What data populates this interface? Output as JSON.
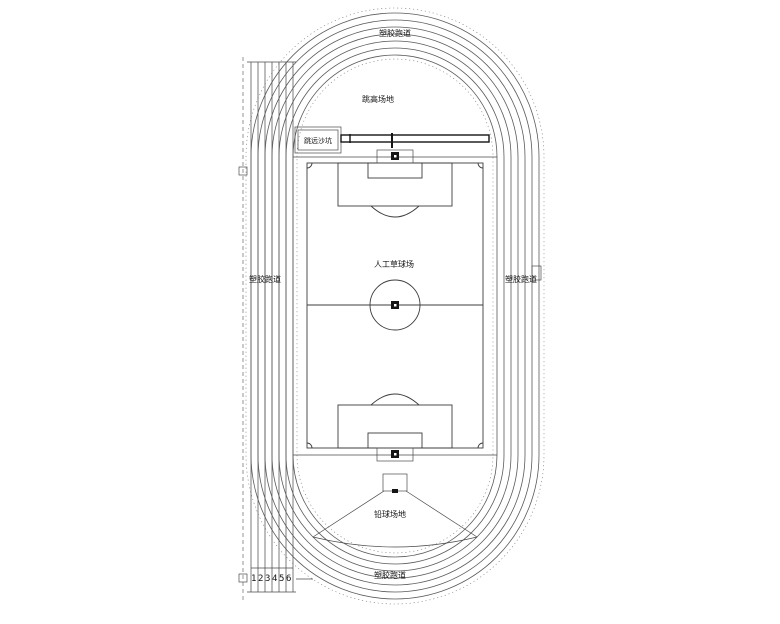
{
  "labels": {
    "track_top": "塑胶跑道",
    "track_bottom": "塑胶跑道",
    "track_left": "塑胶跑道",
    "track_right": "塑胶跑道",
    "high_jump_area": "跳高场地",
    "long_jump_pit": "跳远沙坑",
    "field_center": "人工草球场",
    "shot_put_area": "铅球场地"
  },
  "lane_numbers": [
    "1",
    "2",
    "3",
    "4",
    "5",
    "6"
  ],
  "colors": {
    "line": "#5a5a5a",
    "field_line": "#3c3c3c",
    "dark": "#141414",
    "background": "#ffffff"
  }
}
